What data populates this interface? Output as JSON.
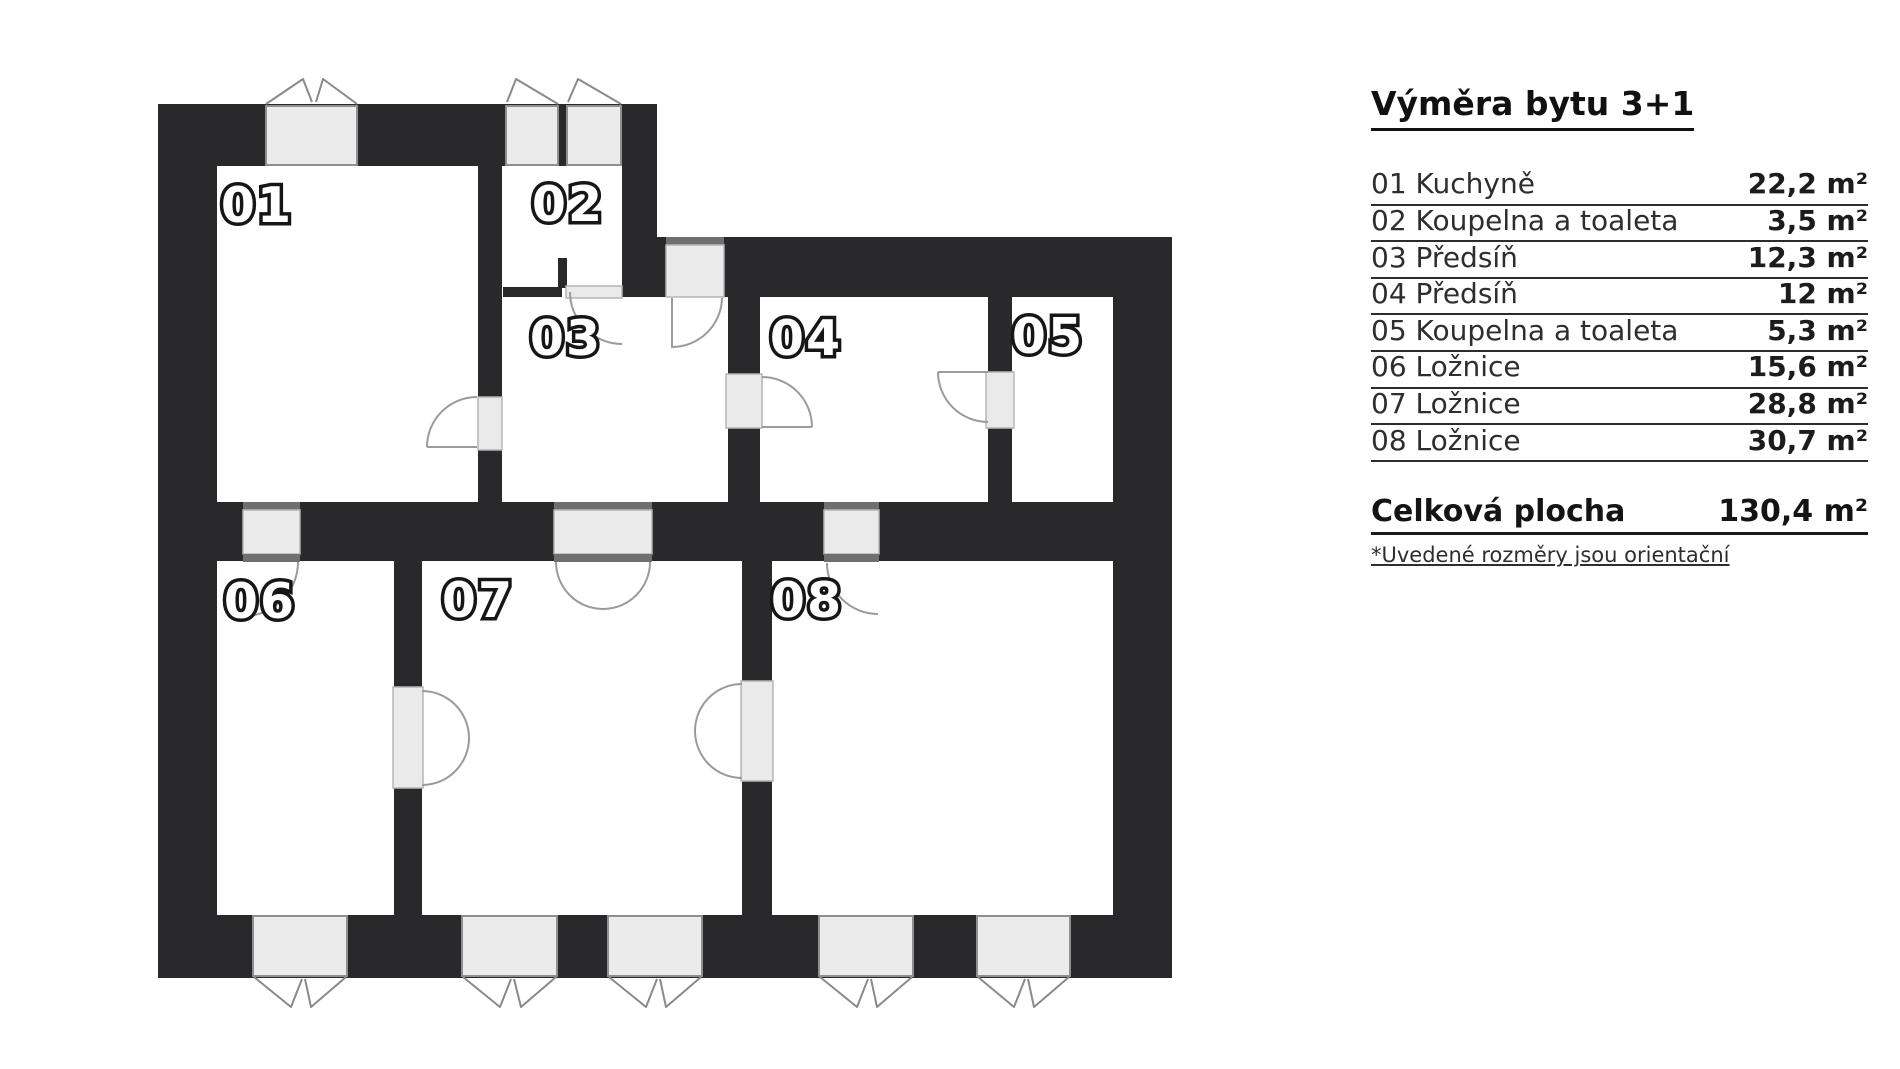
{
  "page": {
    "background": "#ffffff"
  },
  "plan": {
    "rooms": [
      {
        "label": "01"
      },
      {
        "label": "02"
      },
      {
        "label": "03"
      },
      {
        "label": "04"
      },
      {
        "label": "05"
      },
      {
        "label": "06"
      },
      {
        "label": "07"
      },
      {
        "label": "08"
      }
    ],
    "colors": {
      "wall": "#29292b",
      "window_fill": "#ebebeb",
      "window_border": "#8f8f8f",
      "door_fill": "#eaeaea",
      "frame": "#6f6f6f",
      "arc": "#9b9b9b",
      "label_fill": "#ffffff",
      "label_outline": "#161616"
    }
  },
  "legend": {
    "title": "Výměra bytu 3+1",
    "rows": [
      {
        "label": "01 Kuchyně",
        "value": "22,2 m²"
      },
      {
        "label": "02 Koupelna a toaleta",
        "value": "3,5 m²"
      },
      {
        "label": "03 Předsíň",
        "value": "12,3 m²"
      },
      {
        "label": "04 Předsíň",
        "value": "12 m²"
      },
      {
        "label": "05 Koupelna a toaleta",
        "value": "5,3 m²"
      },
      {
        "label": "06 Ložnice",
        "value": "15,6 m²"
      },
      {
        "label": "07 Ložnice",
        "value": "28,8 m²"
      },
      {
        "label": "08 Ložnice",
        "value": "30,7 m²"
      }
    ],
    "total": {
      "label": "Celková plocha",
      "value": "130,4 m²"
    },
    "footnote": "*Uvedené rozměry jsou orientační"
  }
}
